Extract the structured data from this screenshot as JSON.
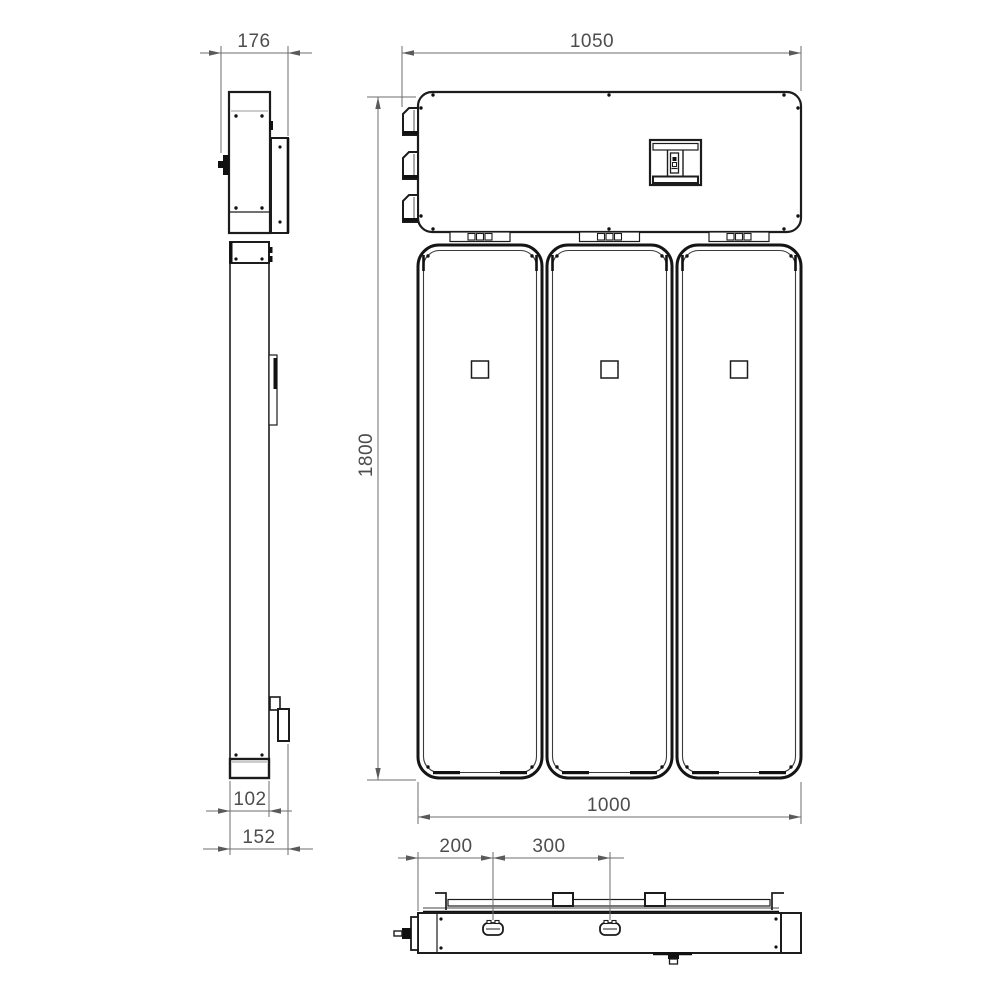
{
  "drawing": {
    "type": "technical-orthographic-drawing",
    "subject": "three-panel electric radiator with top control box, side / front / bottom views",
    "colors": {
      "line": "#1c1c1c",
      "dimension": "#6e6e6e",
      "text": "#4d4d4d",
      "background": "#ffffff"
    },
    "views": {
      "side": {
        "dimensions": {
          "top_unit_depth": "176",
          "panel_depth": "102",
          "overall_depth": "152"
        }
      },
      "front": {
        "dimensions": {
          "overall_width": "1050",
          "overall_height": "1800",
          "panel_assembly_width": "1000"
        }
      },
      "bottom": {
        "dimensions": {
          "valve_offset_from_edge": "200",
          "valve_spacing": "300"
        }
      }
    }
  }
}
